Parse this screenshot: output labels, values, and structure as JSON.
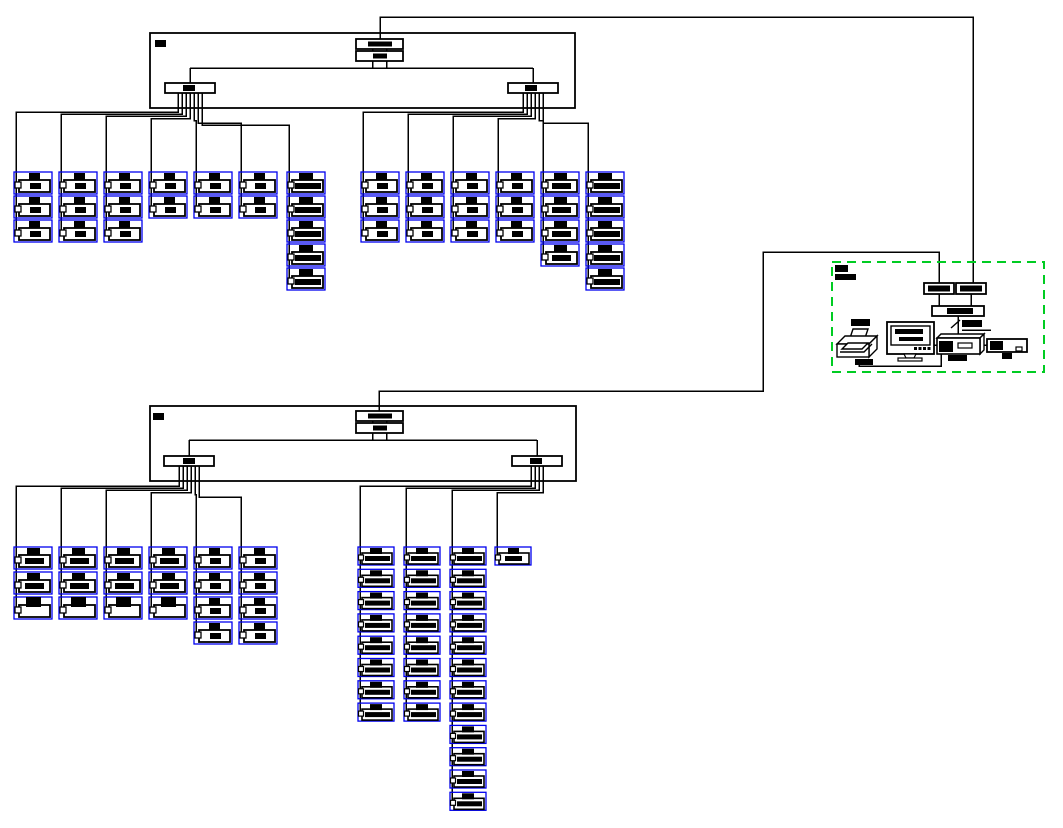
{
  "canvas": {
    "width": 1063,
    "height": 828,
    "background": "#ffffff"
  },
  "colors": {
    "line": "#000000",
    "device_outline": "#0000ee",
    "station_zone_dashed": "#00cc22",
    "fill": "#ffffff",
    "label_blocks": "#000000"
  },
  "text_legible": false,
  "device_type_legend": {
    "A": "device-small-square-mark",
    "B": "device-wide-bar",
    "M": "device-medium-bar",
    "C": "device-large-top-mark"
  },
  "panels": [
    {
      "id": "panel-1",
      "position": "top",
      "controller_rows": 2,
      "title_blob": true,
      "risers": [
        {
          "id": "riser-1-left",
          "columns": [
            {
              "devices": [
                "A",
                "A",
                "A"
              ]
            },
            {
              "devices": [
                "A",
                "A",
                "A"
              ]
            },
            {
              "devices": [
                "A",
                "A",
                "A"
              ]
            },
            {
              "devices": [
                "A",
                "A"
              ]
            },
            {
              "devices": [
                "A",
                "A"
              ]
            },
            {
              "devices": [
                "A",
                "A"
              ]
            },
            {
              "devices": [
                "B",
                "B",
                "B",
                "B",
                "B"
              ]
            }
          ]
        },
        {
          "id": "riser-1-right",
          "columns": [
            {
              "devices": [
                "A",
                "A",
                "A"
              ]
            },
            {
              "devices": [
                "A",
                "A",
                "A"
              ]
            },
            {
              "devices": [
                "A",
                "A",
                "A"
              ]
            },
            {
              "devices": [
                "A",
                "A",
                "A"
              ]
            },
            {
              "devices": [
                "M",
                "M",
                "M",
                "M"
              ]
            },
            {
              "devices": [
                "B",
                "B",
                "B",
                "B",
                "B"
              ]
            }
          ]
        }
      ]
    },
    {
      "id": "panel-2",
      "position": "bottom",
      "controller_rows": 2,
      "title_blob": true,
      "risers": [
        {
          "id": "riser-2-left",
          "columns": [
            {
              "devices": [
                "M",
                "M",
                "C"
              ]
            },
            {
              "devices": [
                "M",
                "M",
                "C"
              ]
            },
            {
              "devices": [
                "M",
                "M",
                "C"
              ]
            },
            {
              "devices": [
                "M",
                "M",
                "C"
              ]
            },
            {
              "devices": [
                "A",
                "A",
                "A",
                "A"
              ]
            },
            {
              "devices": [
                "A",
                "A",
                "A",
                "A"
              ]
            }
          ]
        },
        {
          "id": "riser-2-right",
          "columns": [
            {
              "devices": [
                "B",
                "B",
                "B",
                "B",
                "B",
                "B",
                "B",
                "B"
              ]
            },
            {
              "devices": [
                "B",
                "B",
                "B",
                "B",
                "B",
                "B",
                "B",
                "B"
              ]
            },
            {
              "devices": [
                "B",
                "B",
                "B",
                "B",
                "B",
                "B",
                "B",
                "B",
                "B",
                "B",
                "B",
                "B"
              ]
            },
            {
              "devices": [
                "M"
              ]
            }
          ]
        }
      ]
    }
  ],
  "station": {
    "zone_style": "dashed-green-rectangle",
    "zone_label_blobs": 2,
    "equipment": [
      {
        "name": "converter-1",
        "type": "interface-box",
        "label_blobs": 1
      },
      {
        "name": "converter-2",
        "type": "interface-box",
        "label_blobs": 1
      },
      {
        "name": "hub",
        "type": "interface-bar",
        "label_blobs": 1
      },
      {
        "name": "printer",
        "type": "printer",
        "label_blobs": 2
      },
      {
        "name": "monitor",
        "type": "crt-monitor",
        "screen_text_lines": 2
      },
      {
        "name": "workstation",
        "type": "desktop-pc",
        "label_blobs": 1
      },
      {
        "name": "peripheral",
        "type": "device-box",
        "label_blobs": 1
      },
      {
        "name": "connection-tick",
        "type": "slash-marker-with-label",
        "label_blobs": 1
      }
    ]
  }
}
